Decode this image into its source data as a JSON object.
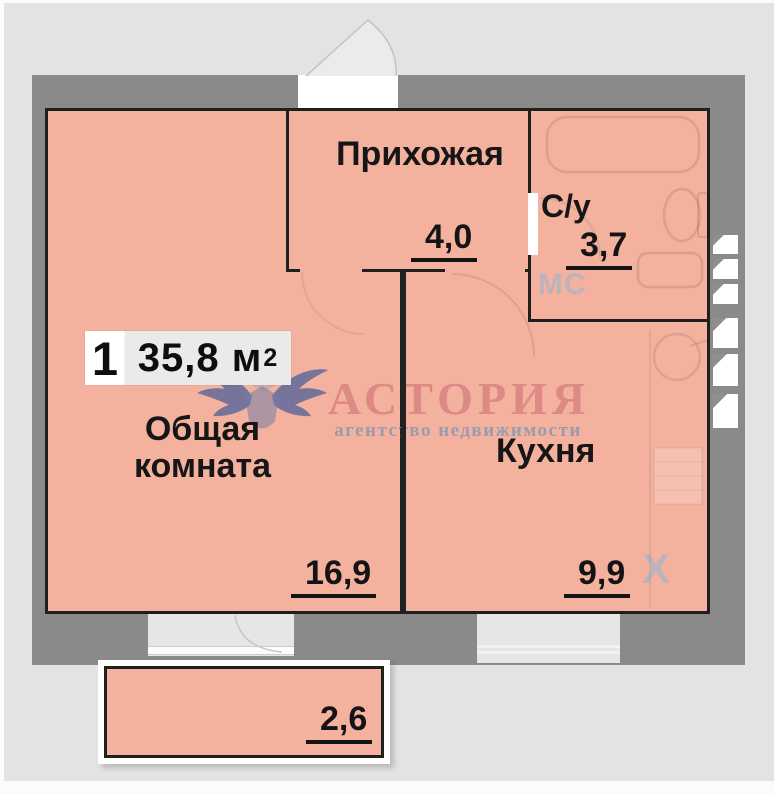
{
  "badge": {
    "room_count": "1",
    "area_value": "35,8",
    "area_unit": "м",
    "area_sup": "2"
  },
  "rooms": {
    "living": {
      "name_line1": "Общая",
      "name_line2": "комната",
      "area": "16,9"
    },
    "hallway": {
      "name": "Прихожая",
      "area": "4,0"
    },
    "bathroom": {
      "name": "С/у",
      "area": "3,7",
      "marker": "МС"
    },
    "kitchen": {
      "name": "Кухня",
      "area": "9,9",
      "marker": "Х"
    },
    "balcony": {
      "area": "2,6"
    }
  },
  "watermark": {
    "brand": "АСТОРИЯ",
    "tagline": "агентство недвижимости"
  },
  "colors": {
    "room_fill": "#f3b19e",
    "wall": "#8a8a8a",
    "background": "#e3e3e3",
    "room_border": "#1f1f1f",
    "brand_text": "#d98382",
    "tagline_text": "#8f99b0",
    "marker_text": "#aab4c8"
  }
}
